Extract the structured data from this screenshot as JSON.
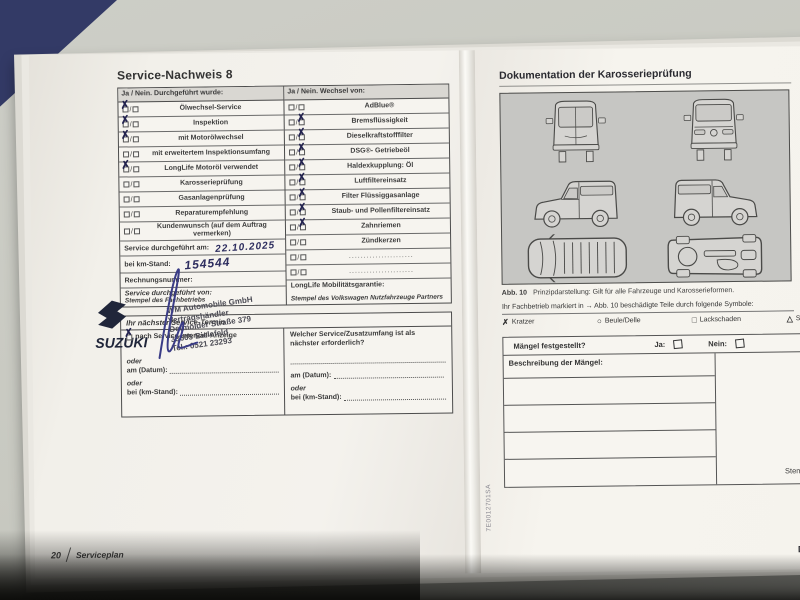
{
  "left_page": {
    "title": "Service-Nachweis 8",
    "checklist": {
      "left_header": "Ja / Nein. Durchgeführt wurde:",
      "right_header": "Ja / Nein. Wechsel von:",
      "left_rows": [
        {
          "label": "Ölwechsel-Service",
          "ja": true,
          "nein": false
        },
        {
          "label": "Inspektion",
          "ja": true,
          "nein": false
        },
        {
          "label": "mit Motorölwechsel",
          "ja": true,
          "nein": false
        },
        {
          "label": "mit erweitertem Inspektionsumfang",
          "ja": false,
          "nein": false
        },
        {
          "label": "LongLife Motoröl verwendet",
          "ja": true,
          "nein": false
        },
        {
          "label": "Karosserieprüfung",
          "ja": false,
          "nein": false
        },
        {
          "label": "Gasanlagenprüfung",
          "ja": false,
          "nein": false
        },
        {
          "label": "Reparaturempfehlung",
          "ja": false,
          "nein": false
        },
        {
          "label": "Kundenwunsch (auf dem Auftrag vermerken)",
          "ja": false,
          "nein": false
        }
      ],
      "right_rows": [
        {
          "label": "AdBlue®",
          "ja": false,
          "nein": false
        },
        {
          "label": "Bremsflüssigkeit",
          "ja": false,
          "nein": true
        },
        {
          "label": "Dieselkraftstofffilter",
          "ja": false,
          "nein": true
        },
        {
          "label": "DSG®- Getriebeöl",
          "ja": false,
          "nein": true
        },
        {
          "label": "Haldexkupplung: Öl",
          "ja": false,
          "nein": true
        },
        {
          "label": "Luftfiltereinsatz",
          "ja": false,
          "nein": true
        },
        {
          "label": "Filter Flüssiggasanlage",
          "ja": false,
          "nein": true
        },
        {
          "label": "Staub- und Pollenfiltereinsatz",
          "ja": false,
          "nein": true
        },
        {
          "label": "Zahnriemen",
          "ja": false,
          "nein": true
        },
        {
          "label": "Zündkerzen",
          "ja": false,
          "nein": false
        },
        {
          "label": "",
          "ja": false,
          "nein": false
        },
        {
          "label": "",
          "ja": false,
          "nein": false
        }
      ]
    },
    "service_date": {
      "label": "Service durchgeführt am:",
      "value": "22.10.2025"
    },
    "km": {
      "label": "bei km-Stand:",
      "value": "154544"
    },
    "invoice_label": "Rechnungsnummer:",
    "service_by_label": "Service durchgeführt von:",
    "stamp": {
      "brand": "SUZUKI",
      "line1": "WM Automobile GmbH",
      "line2": "Vertragshändler",
      "line3": "Detmolder Straße 379",
      "line4": "33605 Bielefeld",
      "line5": "Tel.: 0521 23293"
    },
    "stamp_caption_left": "Stempel des Fachbetriebs",
    "longlife_label": "LongLife Mobilitätsgarantie:",
    "stamp_caption_right": "Stempel des Volkswagen Nutzfahrzeuge Partners",
    "next_service": {
      "header": "Ihr nächster Service-Termin",
      "interval_label": "nach Service-Intervall-Anzeige",
      "interval_checked": true,
      "or_label": "oder",
      "date_label": "am (Datum):",
      "km_label": "bei (km-Stand):",
      "question": "Welcher Service/Zusatzumfang ist als nächster erforderlich?"
    },
    "footer": {
      "page_number": "20",
      "label": "Serviceplan"
    }
  },
  "right_page": {
    "title": "Dokumentation der Karosserieprüfung",
    "figure": {
      "label": "Abb. 10",
      "caption": "Prinzipdarstellung: Gilt für alle Fahrzeuge und Karosserieformen."
    },
    "instruction": "Ihr Fachbetrieb markiert in → Abb. 10 beschädigte Teile durch folgende Symbole:",
    "symbols": [
      {
        "glyph": "✗",
        "label": "Kratzer"
      },
      {
        "glyph": "○",
        "label": "Beule/Delle"
      },
      {
        "glyph": "□",
        "label": "Lackschaden"
      },
      {
        "glyph": "△",
        "label": "Steinschlag"
      }
    ],
    "defects": {
      "question": "Mängel festgestellt?",
      "yes_label": "Ja:",
      "no_label": "Nein:",
      "description_label": "Beschreibung der Mängel:"
    },
    "stamp_caption_partial": "Stempel",
    "part_number": "7E0012701SA",
    "corner_letter": "D"
  }
}
